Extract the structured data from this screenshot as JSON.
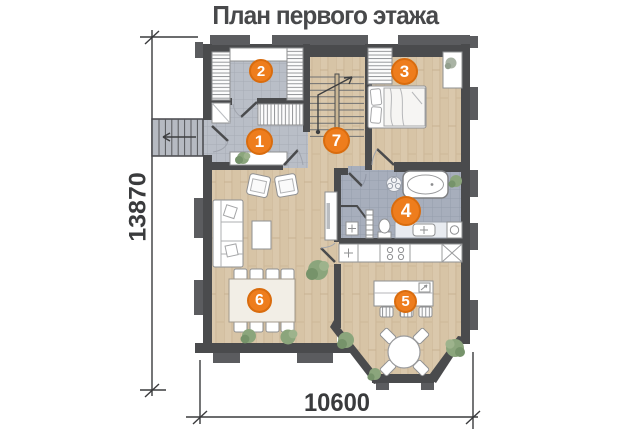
{
  "title": "План первого этажа",
  "dimensions": {
    "height_mm": "13870",
    "width_mm": "10600"
  },
  "rooms": [
    {
      "number": "1"
    },
    {
      "number": "2"
    },
    {
      "number": "3"
    },
    {
      "number": "4"
    },
    {
      "number": "5"
    },
    {
      "number": "6"
    },
    {
      "number": "7"
    }
  ],
  "colors": {
    "accent_badge": "#ee7d1d",
    "badge_ring": "#d96c0e",
    "wall": "#4a4b4d",
    "wood_floor": "#dac8ac",
    "hall_tile": "#b9bec7",
    "bath_tile": "#a7aebc",
    "dimension_text": "#3a3b3d"
  }
}
